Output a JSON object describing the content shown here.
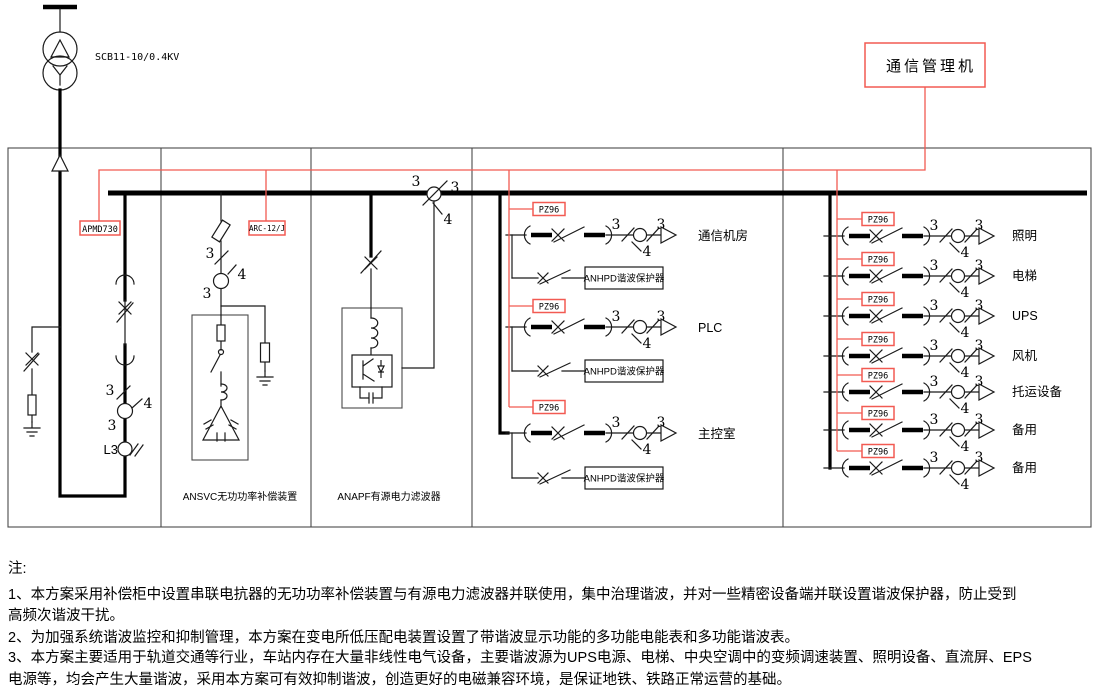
{
  "colors": {
    "accent_red": "#f25a52",
    "ink": "#1a1a1a"
  },
  "transformer": {
    "label": "SCB11-10/0.4KV"
  },
  "comm": {
    "manager_label": "通信管理机",
    "incomer_meter": "APMD730",
    "reactive_controller": "ARC-12/J",
    "panel_meter": "PZ96"
  },
  "ct": {
    "top": "3",
    "right": "3",
    "bottom": "4",
    "lamp": "L3"
  },
  "sections": {
    "svc_label": "ANSVC无功功率补偿装置",
    "apf_label": "ANAPF有源电力滤波器",
    "protector_label": "ANHPD谐波保护器"
  },
  "feeders_meter_panel": [
    "通信机房",
    "PLC",
    "主控室"
  ],
  "feeders_distribution": [
    "照明",
    "电梯",
    "UPS",
    "风机",
    "托运设备",
    "备用",
    "备用"
  ],
  "notes": {
    "heading": "注:",
    "line1": "1、本方案采用补偿柜中设置串联电抗器的无功功率补偿装置与有源电力滤波器并联使用，集中治理谐波，并对一些精密设备端并联设置谐波保护器，防止受到",
    "line2": "高频次谐波干扰。",
    "line3": "2、为加强系统谐波监控和抑制管理，本方案在变电所低压配电装置设置了带谐波显示功能的多功能电能表和多功能谐波表。",
    "line4": "3、本方案主要适用于轨道交通等行业，车站内存在大量非线性电气设备，主要谐波源为UPS电源、电梯、中央空调中的变频调速装置、照明设备、直流屏、EPS",
    "line5": "电源等，均会产生大量谐波，采用本方案可有效抑制谐波，创造更好的电磁兼容环境，是保证地铁、铁路正常运营的基础。"
  }
}
